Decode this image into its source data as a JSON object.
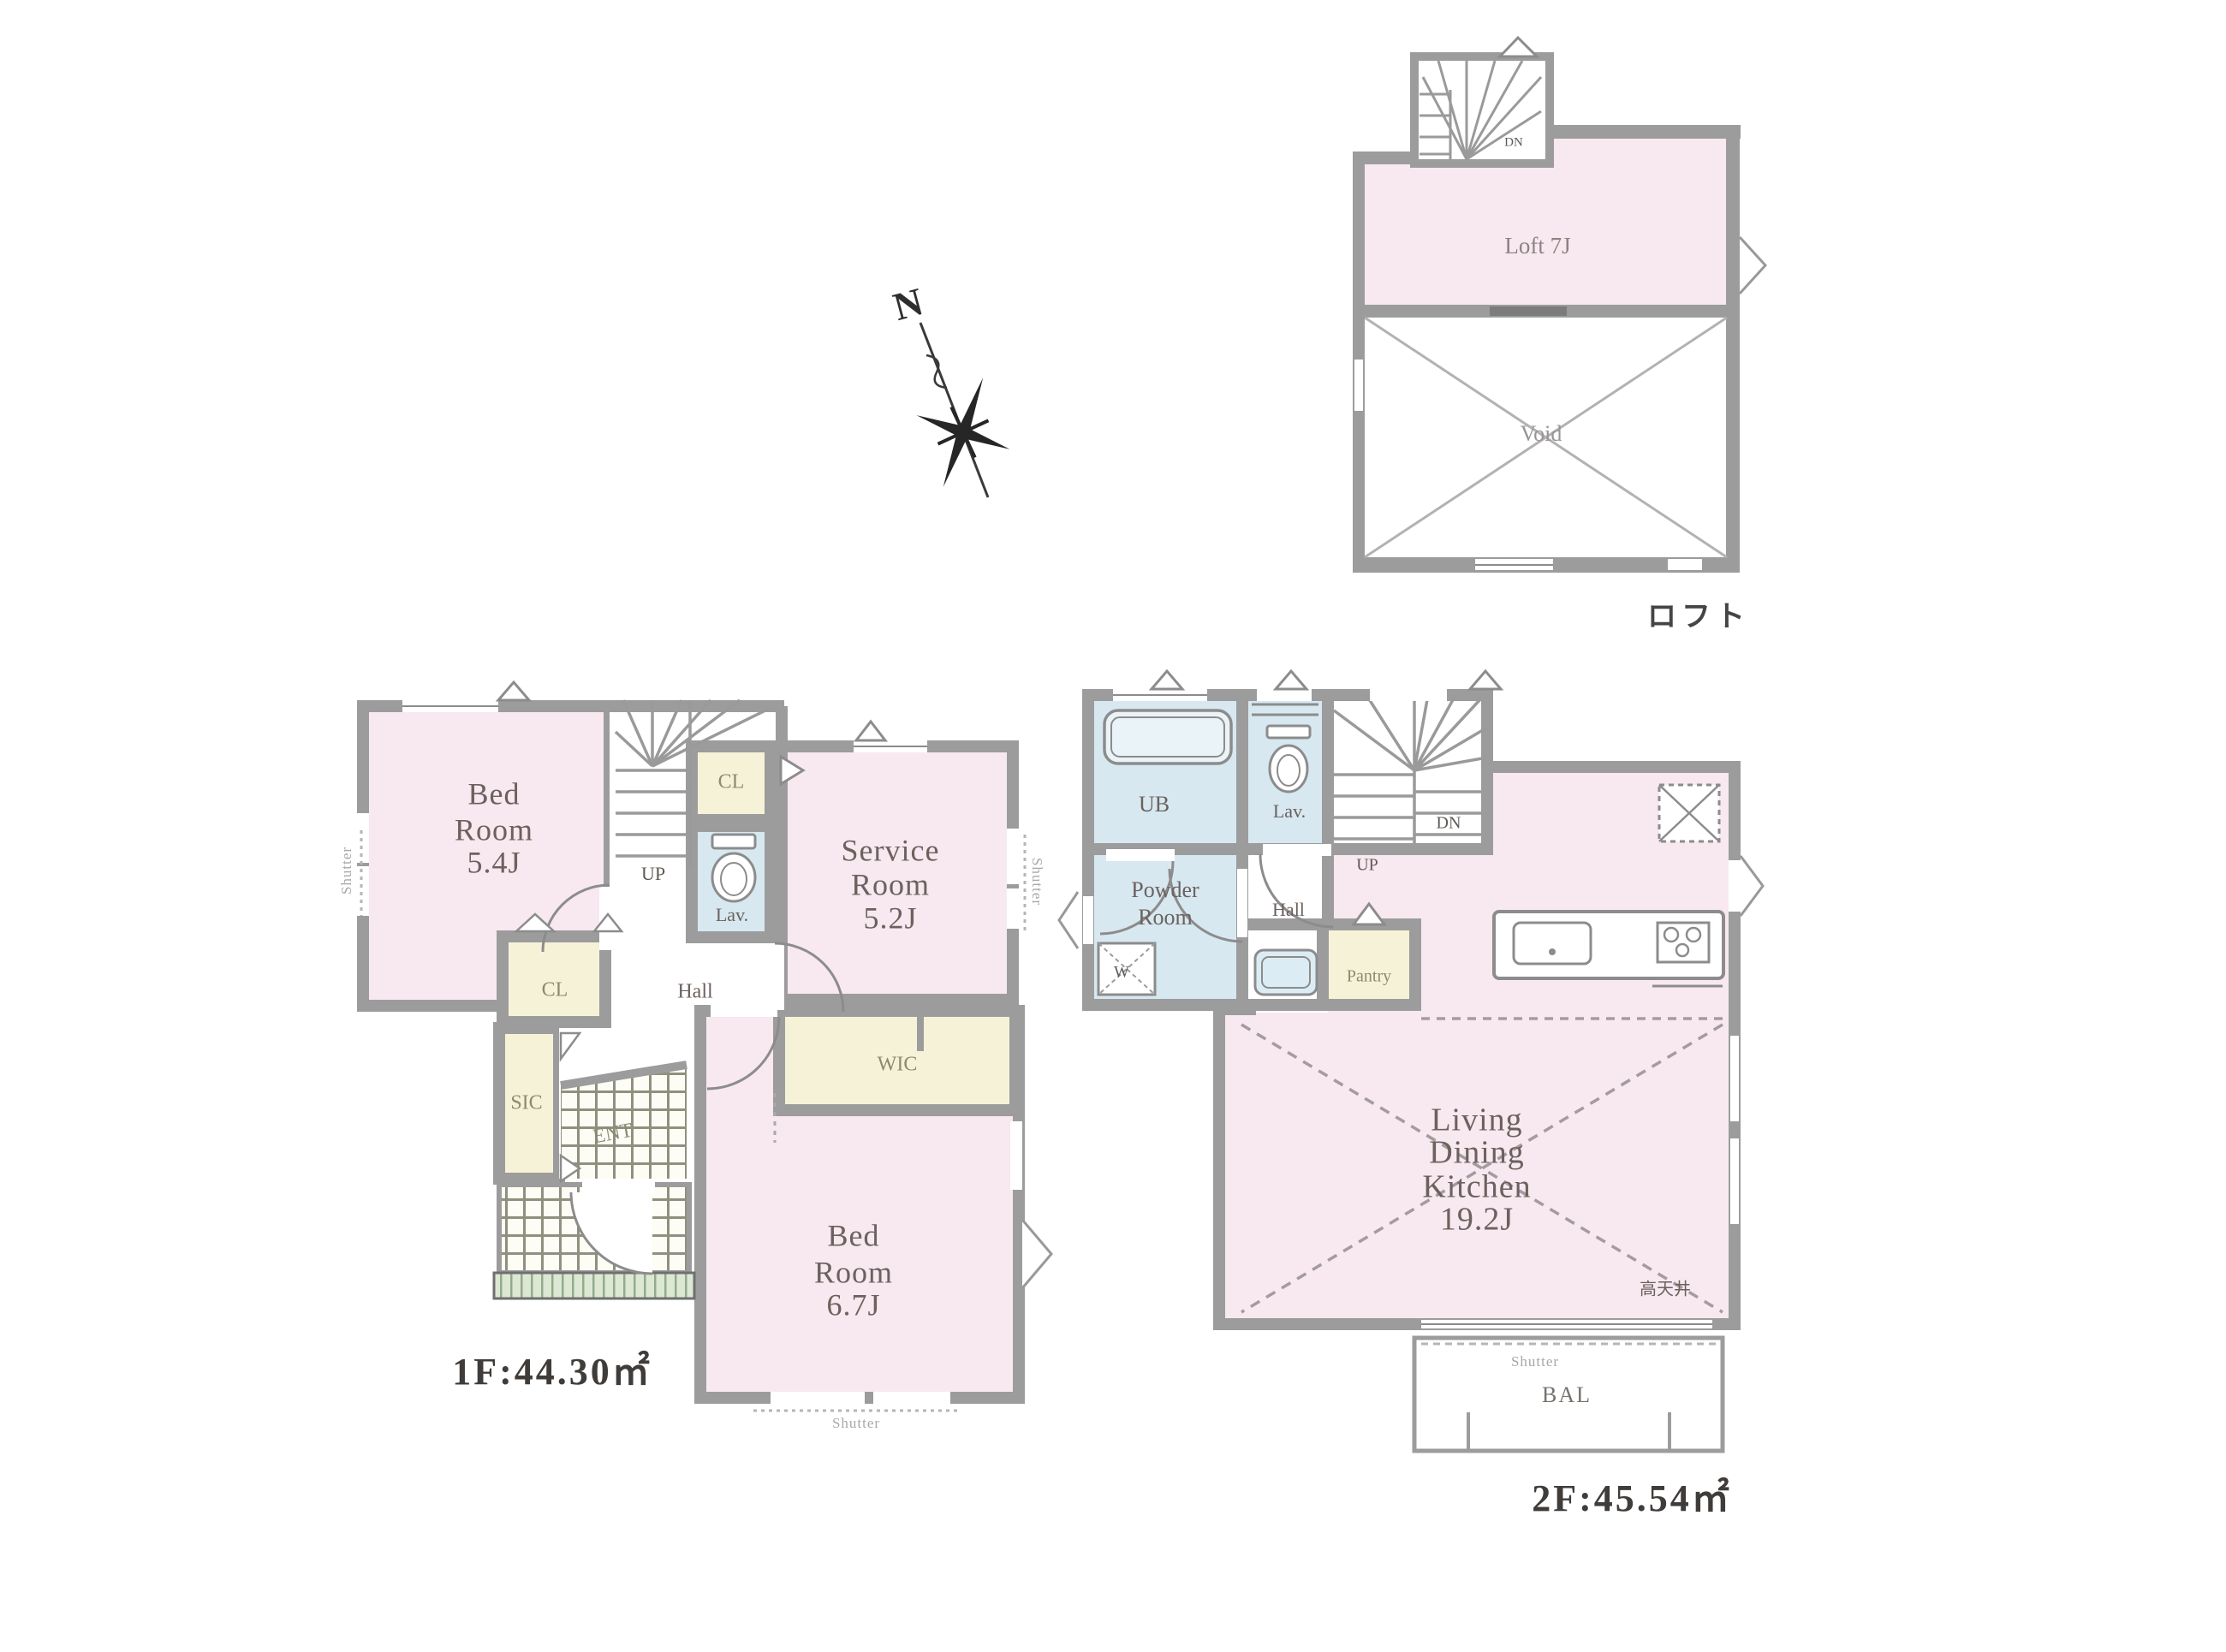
{
  "colors": {
    "background": "#ffffff",
    "room_pink": "#f8e8f0",
    "closet_cream": "#f6f2d8",
    "water_blue": "#d7e8f1",
    "wall_gray": "#9c9c9c",
    "porch_green": "#dce8d3",
    "text_gray": "#6b625e",
    "area_text": "#403c3a"
  },
  "compass": {
    "north_label": "N"
  },
  "loft_plan": {
    "title": "ロフト",
    "room_label": "Loft 7J",
    "void_label": "Void",
    "stairs_label": "DN"
  },
  "floor1_plan": {
    "area_label": "1F:44.30㎡",
    "bedroom1": {
      "lines": [
        "Bed",
        "Room",
        "5.4J"
      ]
    },
    "service_room": {
      "lines": [
        "Service",
        "Room",
        "5.2J"
      ]
    },
    "bedroom2": {
      "lines": [
        "Bed",
        "Room",
        "6.7J"
      ]
    },
    "closet_top": "CL",
    "closet_mid": "CL",
    "lavatory": "Lav.",
    "hall": "Hall",
    "shoe_closet": "SIC",
    "entrance": "ENT",
    "walkin_closet": "WIC",
    "stairs_up": "UP",
    "shutter_left": "Shutter",
    "shutter_right": "Shutter",
    "shutter_bottom": "Shutter"
  },
  "floor2_plan": {
    "area_label": "2F:45.54㎡",
    "unit_bath": "UB",
    "lavatory": "Lav.",
    "stairs_down": "DN",
    "stairs_up": "UP",
    "powder_room": {
      "lines": [
        "Powder",
        "Room"
      ]
    },
    "washer": "W",
    "hall": "Hall",
    "pantry": "Pantry",
    "ldk": {
      "lines": [
        "Living",
        "Dining",
        "Kitchen",
        "19.2J"
      ]
    },
    "high_ceiling": "高天井",
    "balcony": "BAL",
    "shutter_balcony": "Shutter"
  }
}
